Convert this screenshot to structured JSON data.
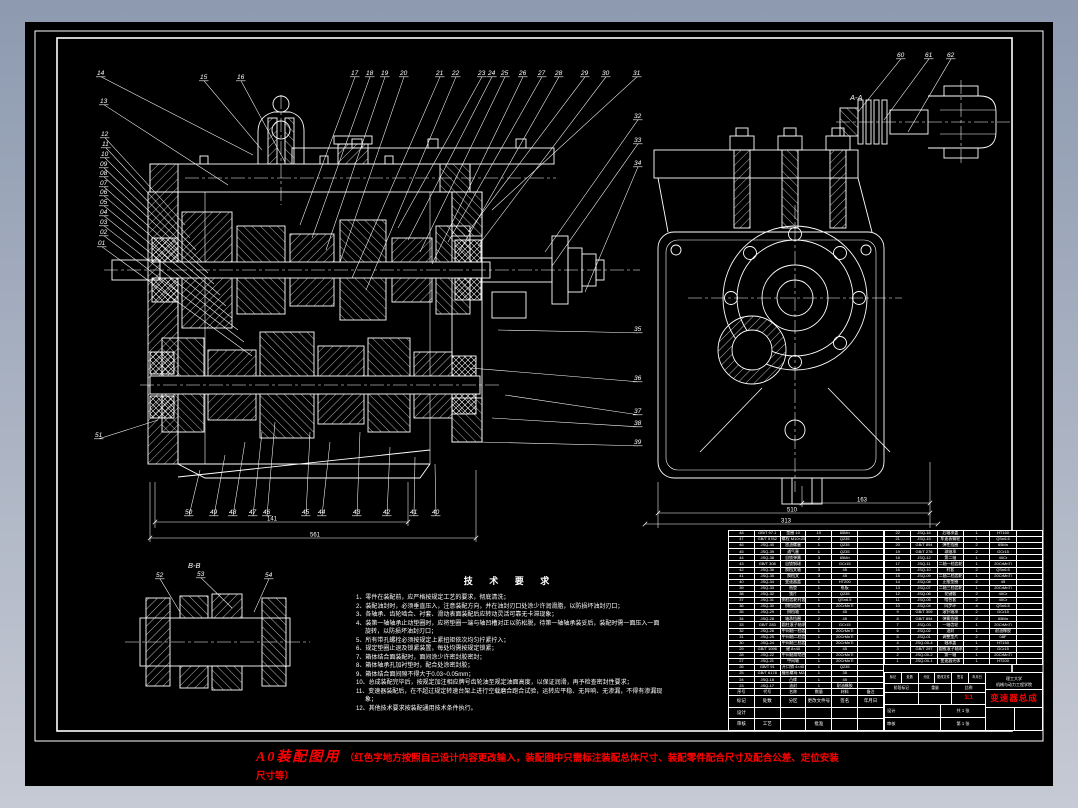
{
  "palette": {
    "background_top": "#8d9ab0",
    "background_bottom": "#c6cad4",
    "sheet": "#000000",
    "line": "#ffffff",
    "accent_red": "#ff0000"
  },
  "sections": {
    "aa": "A-A",
    "bb": "B-B"
  },
  "callout_labels": [
    "14",
    "13",
    "12",
    "11",
    "10",
    "09",
    "08",
    "07",
    "06",
    "05",
    "04",
    "03",
    "02",
    "01",
    "51",
    "15",
    "16",
    "17",
    "18",
    "19",
    "20",
    "21",
    "22",
    "23",
    "24",
    "25",
    "26",
    "27",
    "28",
    "29",
    "30",
    "31",
    "32",
    "33",
    "34",
    "35",
    "36",
    "37",
    "38",
    "39",
    "50",
    "49",
    "48",
    "47",
    "46",
    "45",
    "44",
    "43",
    "42",
    "41",
    "40",
    "52",
    "53",
    "54",
    "60",
    "61",
    "62"
  ],
  "dims": {
    "values": [
      "141",
      "561",
      "163",
      "510",
      "313"
    ]
  },
  "tech": {
    "title": "技 术 要 求",
    "items": [
      "1、零件在装配前，应严格按规定工艺的要求，彻底清洗；",
      "2、装配油封时，必须垂直压入，注意装配方向，并在油封刃口处涂少许润滑脂，以防损坏油封刃口；",
      "3、各轴承、齿轮啮合、衬套、滑动表面装配后应转动灵活可靠无卡滞现象；",
      "4、装第一轴轴承止动垫圈时，应将垫圈一端与轴凹槽对正以防松脱，待第一轴轴承装妥后，装配时需一面压入一面旋转，以防损坏油封刃口；",
      "5、所有带孔螺栓必须按规定上紧扭矩依次均匀拧紧拧入；",
      "6、规定垫圈止退及锁紧装置，每处均需按规定锁紧；",
      "7、箱体结合面装配时，面间涂少许密封胶密封；",
      "8、箱体轴承孔加衬垫时，配合处涂密封胶；",
      "9、箱体结合面间隙不得大于0.03~0.05mm；",
      "10、总成装配完毕后，按规定加注相应牌号齿轮油至规定油面高度，以保证润滑，再予检查密封性要求；",
      "11、变速器装配后，在不超过规定转速台架上进行空载磨合跑合试验，运转应平稳、无异响、无渗漏，不得有渗漏现象；",
      "12、其他技术要求按装配通用技术条件执行。"
    ]
  },
  "rednote": {
    "headline": "A0装配图用",
    "body": "（红色字地方按照自己设计内容更改输入，装配图中只需标注装配总体尺寸、装配零件配合尺寸及配合公差、定位安装尺寸等）"
  },
  "bom": {
    "header": [
      "序号",
      "代号",
      "名称",
      "数量",
      "材料",
      "备注"
    ],
    "left_rows": [
      [
        "48",
        "GB/T 97.1",
        "垫圈 10",
        "10",
        "65Mn",
        ""
      ],
      [
        "47",
        "GB/T 5782",
        "螺栓 M10×25",
        "2",
        "Q235",
        ""
      ],
      [
        "46",
        "JSQ-40",
        "放油螺塞",
        "1",
        "Q235",
        ""
      ],
      [
        "45",
        "JSQ-39",
        "通气塞",
        "1",
        "Q235",
        ""
      ],
      [
        "44",
        "JSQ-38",
        "自锁弹簧",
        "3",
        "65Mn",
        ""
      ],
      [
        "43",
        "GB/T 308",
        "自锁钢球",
        "3",
        "GCr15",
        ""
      ],
      [
        "42",
        "JSQ-36",
        "换档叉轴",
        "3",
        "45",
        ""
      ],
      [
        "41",
        "JSQ-35",
        "换档叉",
        "3",
        "45",
        ""
      ],
      [
        "40",
        "JSQ-34",
        "变速器盖",
        "1",
        "HT200",
        ""
      ],
      [
        "39",
        "JSQ-33",
        "纸垫",
        "1",
        "纸板",
        ""
      ],
      [
        "38",
        "JSQ-32",
        "锁片",
        "2",
        "Q235",
        ""
      ],
      [
        "37",
        "JSQ-31",
        "倒档齿轮衬套",
        "1",
        "QSn6.5",
        ""
      ],
      [
        "36",
        "JSQ-30",
        "倒档齿轮",
        "1",
        "20CrMnTi",
        ""
      ],
      [
        "35",
        "JSQ-29",
        "倒档轴",
        "1",
        "45",
        ""
      ],
      [
        "34",
        "JSQ-28",
        "轴承挡圈",
        "2",
        "45",
        ""
      ],
      [
        "33",
        "GB/T 283",
        "圆柱滚子轴承",
        "2",
        "GCr15",
        ""
      ],
      [
        "32",
        "JSQ-26",
        "中间轴一档齿轮",
        "1",
        "20CrMnTi",
        ""
      ],
      [
        "31",
        "JSQ-25",
        "中间轴二档齿轮",
        "1",
        "20CrMnTi",
        ""
      ],
      [
        "30",
        "JSQ-24",
        "中间轴三档齿轮",
        "1",
        "20CrMnTi",
        ""
      ],
      [
        "29",
        "GB/T 1096",
        "键 8×40",
        "2",
        "45",
        ""
      ],
      [
        "28",
        "JSQ-22",
        "中间轴常啮合齿轮",
        "1",
        "20CrMnTi",
        ""
      ],
      [
        "27",
        "JSQ-21",
        "中间轴",
        "1",
        "20CrMnTi",
        ""
      ],
      [
        "26",
        "GB/T 91",
        "开口销 4×40",
        "1",
        "Q235",
        ""
      ],
      [
        "25",
        "GB/T 6178",
        "槽形螺母 M24×1.5",
        "1",
        "35",
        ""
      ],
      [
        "24",
        "JSQ-18",
        "凸缘",
        "1",
        "45",
        ""
      ],
      [
        "23",
        "JSQ-17",
        "油封",
        "1",
        "耐油橡胶",
        ""
      ]
    ],
    "right_rows": [
      [
        "22",
        "JSQ-16",
        "后轴承盖",
        "1",
        "HT150",
        ""
      ],
      [
        "21",
        "JSQ-15",
        "车速表蜗轮",
        "1",
        "QSn6.5",
        ""
      ],
      [
        "20",
        "GB/T 894",
        "弹性挡圈",
        "2",
        "65Mn",
        ""
      ],
      [
        "19",
        "GB/T 276",
        "球轴承",
        "2",
        "GCr15",
        ""
      ],
      [
        "18",
        "JSQ-12",
        "第二轴",
        "1",
        "40Cr",
        ""
      ],
      [
        "17",
        "JSQ-11",
        "二轴一档齿轮",
        "1",
        "20CrMnTi",
        ""
      ],
      [
        "16",
        "JSQ-10",
        "衬套",
        "2",
        "QSn6.5",
        ""
      ],
      [
        "15",
        "JSQ-09",
        "二轴二档齿轮",
        "1",
        "20CrMnTi",
        ""
      ],
      [
        "14",
        "JSQ-08",
        "止推垫圈",
        "2",
        "45",
        ""
      ],
      [
        "13",
        "JSQ-07",
        "二轴三档齿轮",
        "1",
        "20CrMnTi",
        ""
      ],
      [
        "12",
        "JSQ-06",
        "花键毂",
        "2",
        "40Cr",
        ""
      ],
      [
        "11",
        "JSQ-05",
        "啮合套",
        "2",
        "40Cr",
        ""
      ],
      [
        "10",
        "JSQ-04",
        "同步环",
        "4",
        "QSn6.5",
        ""
      ],
      [
        "9",
        "GB/T 309",
        "滚针轴承",
        "2",
        "GCr15",
        ""
      ],
      [
        "8",
        "GB/T 894",
        "弹簧挡圈",
        "2",
        "65Mn",
        ""
      ],
      [
        "7",
        "JSQ-03",
        "一轴齿轮",
        "1",
        "20CrMnTi",
        ""
      ],
      [
        "6",
        "JSQ-02",
        "油封",
        "1",
        "耐油橡胶",
        ""
      ],
      [
        "5",
        "JSQ-01",
        "调整垫片",
        "2",
        "08F",
        ""
      ],
      [
        "4",
        "JSQ-00-4",
        "轴承盖",
        "1",
        "HT150",
        ""
      ],
      [
        "3",
        "GB/T 297",
        "圆锥滚子轴承",
        "2",
        "GCr15",
        ""
      ],
      [
        "2",
        "JSQ-00-2",
        "第一轴",
        "1",
        "20CrMnTi",
        ""
      ],
      [
        "1",
        "JSQ-00-1",
        "变速器壳体",
        "1",
        "HT200",
        ""
      ]
    ]
  },
  "titleblock": {
    "tiny_header": [
      "标记",
      "处数",
      "分区",
      "更改文件号",
      "签名",
      "年月日"
    ],
    "stage_label": "阶段标记",
    "weight_label": "重量",
    "scale_label": "比例",
    "scale": "1:1",
    "sig_rows": [
      [
        "设计",
        ""
      ],
      [
        "审核",
        ""
      ],
      [
        "工艺",
        "批准"
      ]
    ],
    "sheet_total": "共 1 张",
    "sheet_no": "第 1 张",
    "school_line1": "理工大学",
    "school_line2": "机械与动力工程学院",
    "title": "变速器总成"
  }
}
